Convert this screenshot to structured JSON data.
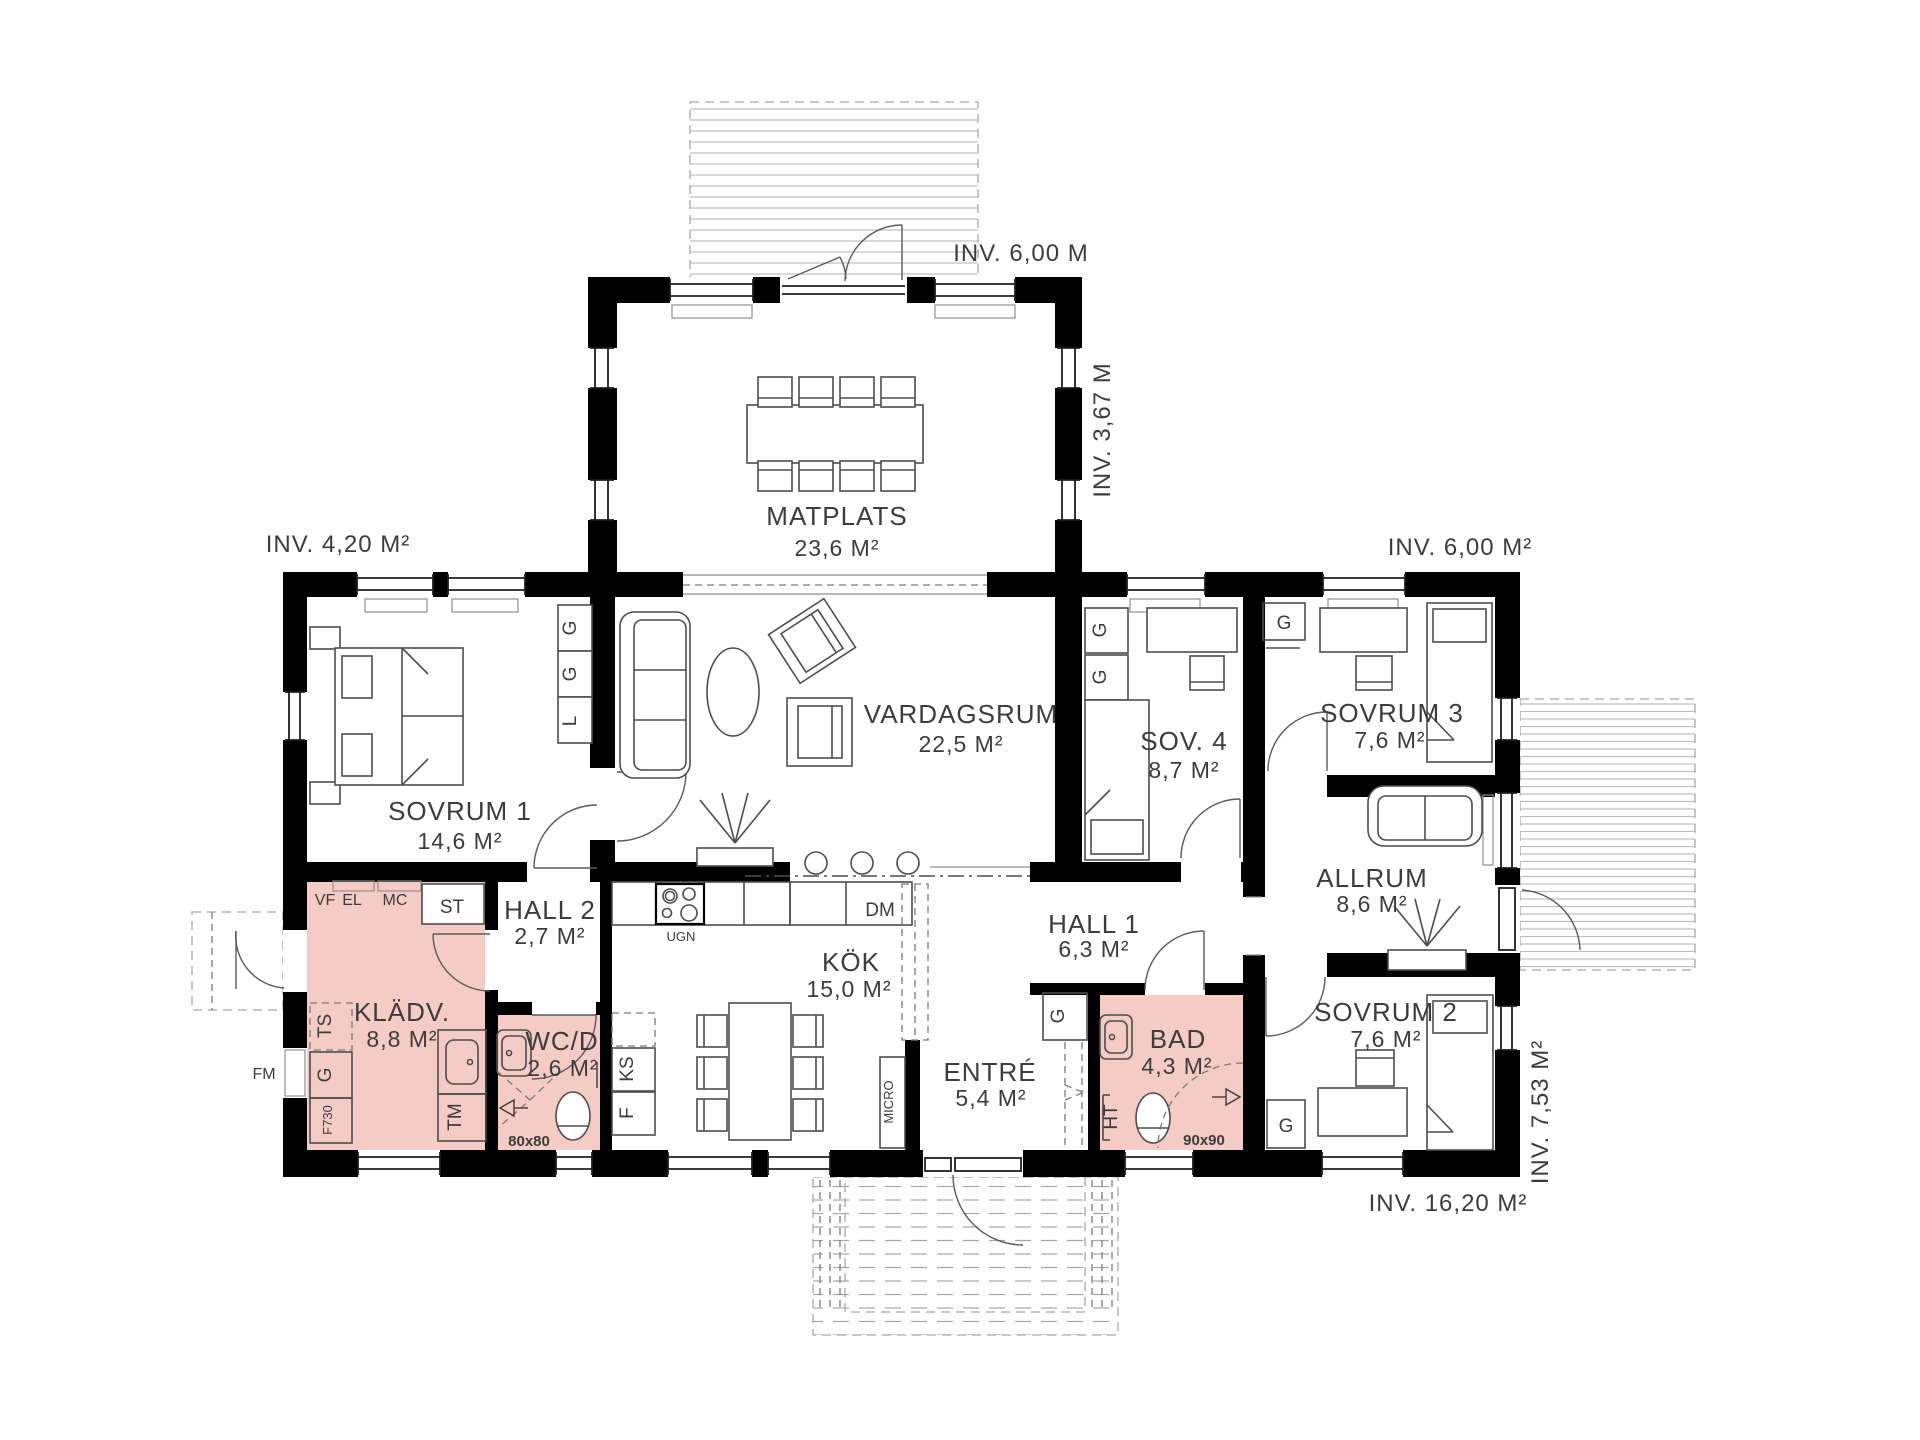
{
  "plan": {
    "colors": {
      "wall": "#000000",
      "wet_room_fill": "#f5cbc5",
      "line": "#4d4d4d",
      "text": "#3c3c3c"
    },
    "rooms": [
      {
        "id": "matplats",
        "name": "MATPLATS",
        "area": "23,6 M²"
      },
      {
        "id": "vardagsrum",
        "name": "VARDAGSRUM",
        "area": "22,5 M²"
      },
      {
        "id": "sovrum1",
        "name": "SOVRUM 1",
        "area": "14,6 M²"
      },
      {
        "id": "sov4",
        "name": "SOV. 4",
        "area": "8,7 M²"
      },
      {
        "id": "sovrum3",
        "name": "SOVRUM 3",
        "area": "7,6 M²"
      },
      {
        "id": "allrum",
        "name": "ALLRUM",
        "area": "8,6 M²"
      },
      {
        "id": "sovrum2",
        "name": "SOVRUM 2",
        "area": "7,6 M²"
      },
      {
        "id": "hall1",
        "name": "HALL 1",
        "area": "6,3 M²"
      },
      {
        "id": "hall2",
        "name": "HALL 2",
        "area": "2,7 M²"
      },
      {
        "id": "kok",
        "name": "KÖK",
        "area": "15,0 M²"
      },
      {
        "id": "entre",
        "name": "ENTRÉ",
        "area": "5,4 M²"
      },
      {
        "id": "kladv",
        "name": "KLÄDV.",
        "area": "8,8 M²"
      },
      {
        "id": "wcd",
        "name": "WC/D",
        "area": "2,6 M²"
      },
      {
        "id": "bad",
        "name": "BAD",
        "area": "4,3 M²"
      }
    ],
    "inv_labels": [
      {
        "id": "top_terrace",
        "text": "INV. 6,00 M"
      },
      {
        "id": "wing_side",
        "text": "INV. 3,67 M"
      },
      {
        "id": "left_side",
        "text": "INV. 4,20 M²"
      },
      {
        "id": "right_top",
        "text": "INV. 6,00 M²"
      },
      {
        "id": "east_side",
        "text": "INV. 7,53 M²"
      },
      {
        "id": "bottom_right",
        "text": "INV. 16,20 M²"
      }
    ],
    "fixture_labels": {
      "vf": "VF",
      "el": "EL",
      "mc": "MC",
      "st": "ST",
      "ts": "TS",
      "g": "G",
      "f730": "F730",
      "fm": "FM",
      "tm": "TM",
      "l": "L",
      "ks": "KS",
      "f": "F",
      "dm": "DM",
      "ugn": "UGN",
      "micro": "MICRO",
      "ht": "HT",
      "shower_small": "80x80",
      "shower_large": "90x90"
    }
  }
}
